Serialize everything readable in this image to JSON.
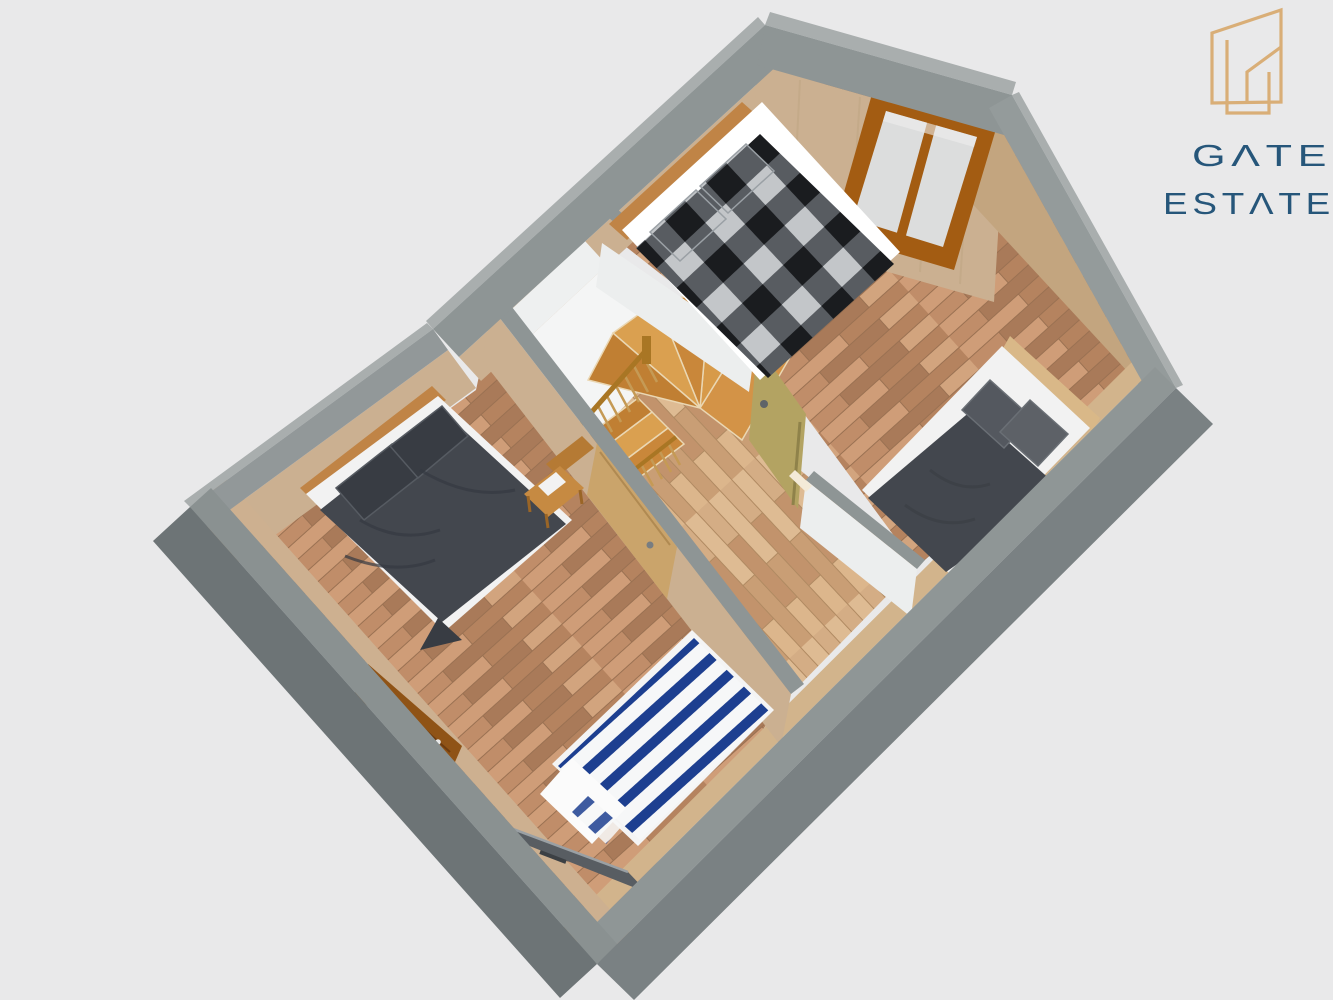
{
  "brand": {
    "line1": "GATE",
    "line2": "ESTATE",
    "display_line1": "GΛTE",
    "display_line2": "ESTΛTE",
    "gold": "#d9ae77",
    "navy": "#26567a"
  },
  "scene": {
    "background": "#e9e9ea",
    "description": "3D axonometric floor plan of an attic storey: two bedrooms, central stair landing with winder staircase, four beds, two doors, one double window",
    "objects": [
      "double-bed-checkered",
      "double-bed-dark",
      "single-bed-striped",
      "single-bed-dark",
      "staircase",
      "stair-railing",
      "window-double",
      "door-right-bedroom",
      "door-left-bedroom",
      "open-door-leaf",
      "tv-panel",
      "wooden-chair"
    ]
  },
  "palette": {
    "wall_top": "#8e9595",
    "wall_top_light": "#a9aeae",
    "wall_outer": "#7a8183",
    "wall_outer_dark": "#6d7476",
    "wood_wall": "#cbb091",
    "wood_wall_dark": "#c3a57f",
    "floor_room": "#c29070",
    "floor_hall": "#d4ad85",
    "baseboard": "#d2b48c",
    "stair_wood": "#cf8c3b",
    "stair_wood_dark": "#c07f33",
    "rail_wood": "#a97624",
    "spindle": "#c59a55",
    "door_tan": "#b3a362",
    "door_leaf_wood": "#caa46b",
    "open_door": "#8f5316",
    "window_frame": "#a35c12",
    "glass": "#dcdddd",
    "white_face": "#f4f5f5",
    "charcoal": "#43474e",
    "charcoal_dark": "#383c43",
    "check_dark": "#1a1c1f",
    "check_mid": "#585c61",
    "check_light": "#c3c6c9",
    "stripe_navy": "#1d3f90",
    "headboard": "#c08446",
    "tv_gray": "#585d62"
  }
}
